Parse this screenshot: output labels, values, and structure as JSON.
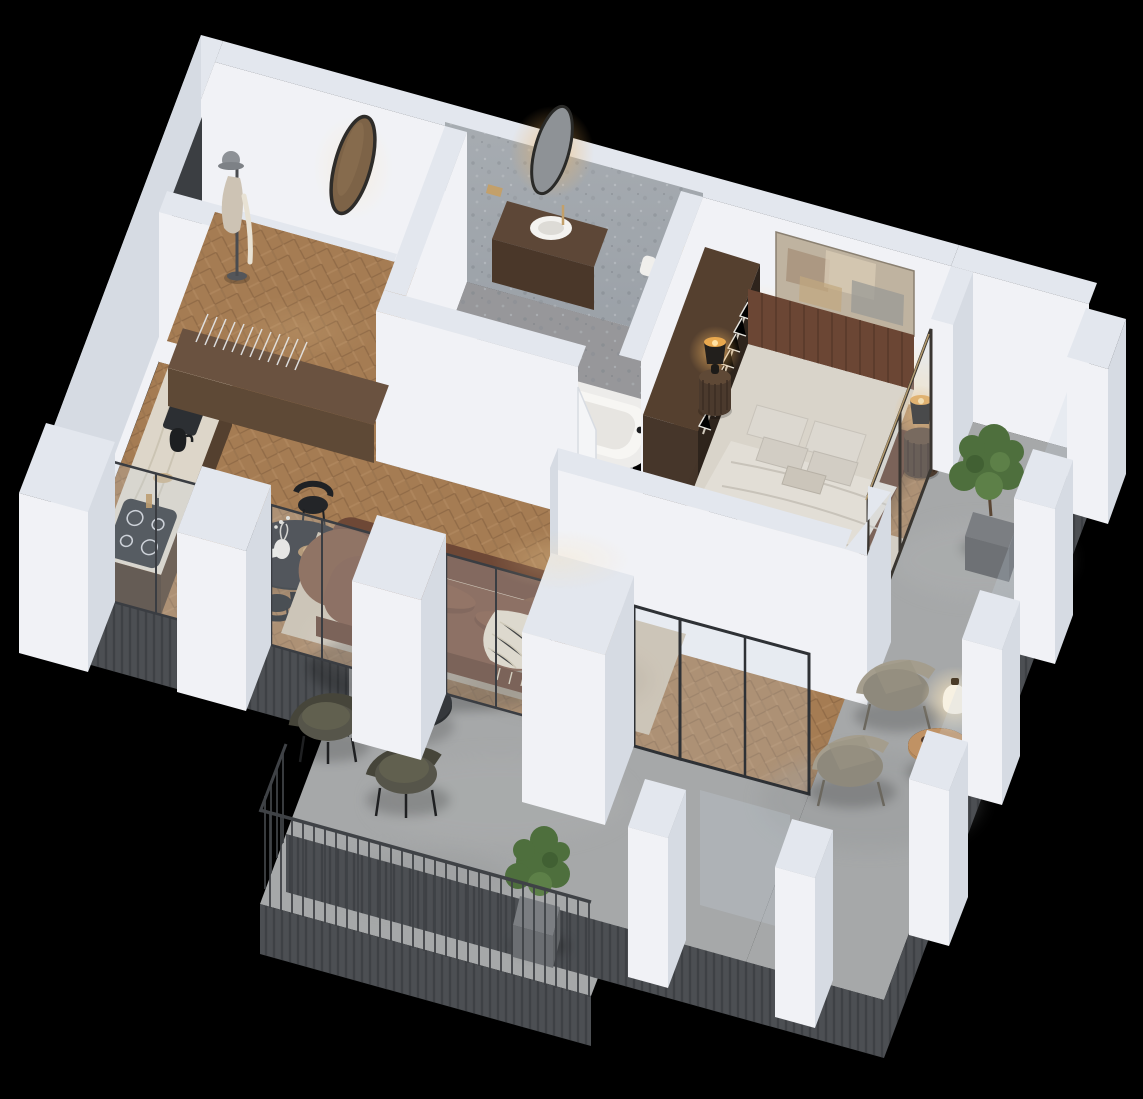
{
  "meta": {
    "canvas_width": 1143,
    "canvas_height": 1099,
    "view": "isometric-3d-floor-plan",
    "background": "#000000"
  },
  "palette": {
    "bg": "#000000",
    "wallTop": "#e3e7ee",
    "wallLit": "#f1f2f6",
    "wallMid": "#d6dbe3",
    "wallShadow": "#c2c8d2",
    "wallDark": "#a9afbb",
    "woodFloor": "#a57c53",
    "woodFloorLight": "#b28a60",
    "woodFloorDark": "#8d6845",
    "concrete": "#a6a8a9",
    "bathFloor": "#97979a",
    "stoneWall": "#9aa0a6",
    "rug": "#cec0ab",
    "bedroomRug": "#d7ccbc",
    "sofaBrown": "#7b523e",
    "sofaBrownDark": "#63402f",
    "bedFrame": "#6b4634",
    "bedding": "#d9d4ca",
    "throwGray": "#8e8b82",
    "throwCream": "#e4dbc8",
    "cabinetWood": "#54402f",
    "counterMarble": "#ddd6c9",
    "armchairOlive": "#56554a",
    "furnBlack": "#26282b",
    "glazing": "rgba(200,214,225,0.24)",
    "frameMetal": "#3a3d42",
    "edgeFascia": "#4c4f53",
    "plantGreen": "#4e6f3d",
    "planter": "#7b7e82",
    "lampGlow": "#f2b45e",
    "lanternGlow": "#ffe9bd",
    "brass": "#c3a06a"
  },
  "scene": {
    "rooms": [
      {
        "name": "entry-hall",
        "floor": "herringbone-wood",
        "items": [
          "entry-door",
          "coat-stand",
          "oval-mirror"
        ]
      },
      {
        "name": "bathroom",
        "floor": "terrazzo",
        "items": [
          "stone-accent-wall",
          "backlit-oval-mirror",
          "vanity-with-vessel-sink",
          "wall-hung-toilet",
          "gold-shower-set",
          "bathtub",
          "white-door"
        ]
      },
      {
        "name": "bedroom",
        "floor": "herringbone-wood",
        "items": [
          "double-bed",
          "two-nightstands-with-lamps",
          "abstract-art",
          "open-wardrobe-with-hangers",
          "area-rug",
          "floor-lamp",
          "glass-door-to-terrace"
        ]
      },
      {
        "name": "kitchen",
        "floor": "herringbone-wood",
        "items": [
          "l-shaped-counter",
          "marble-island",
          "sink-gold-faucet",
          "black-kettle",
          "induction-cooktop",
          "oven",
          "dish-rack"
        ]
      },
      {
        "name": "dining-area",
        "floor": "herringbone-wood",
        "items": [
          "round-black-table",
          "four-black-chairs",
          "vase-with-flowers"
        ]
      },
      {
        "name": "living-room",
        "floor": "herringbone-wood",
        "items": [
          "brown-curved-sofa",
          "cream-throw",
          "round-coffee-table",
          "two-olive-armchairs",
          "beige-rug",
          "glass-wall-to-terrace"
        ]
      },
      {
        "name": "terrace",
        "floor": "concrete",
        "items": [
          "two-woven-lounge-chairs",
          "round-wooden-side-table",
          "glowing-lantern",
          "cube-planter-with-tree",
          "glass-parapet-with-white-piers"
        ]
      },
      {
        "name": "balcony",
        "floor": "concrete",
        "items": [
          "metal-bar-railing",
          "cube-planter-with-plant",
          "white-piers"
        ]
      }
    ]
  }
}
